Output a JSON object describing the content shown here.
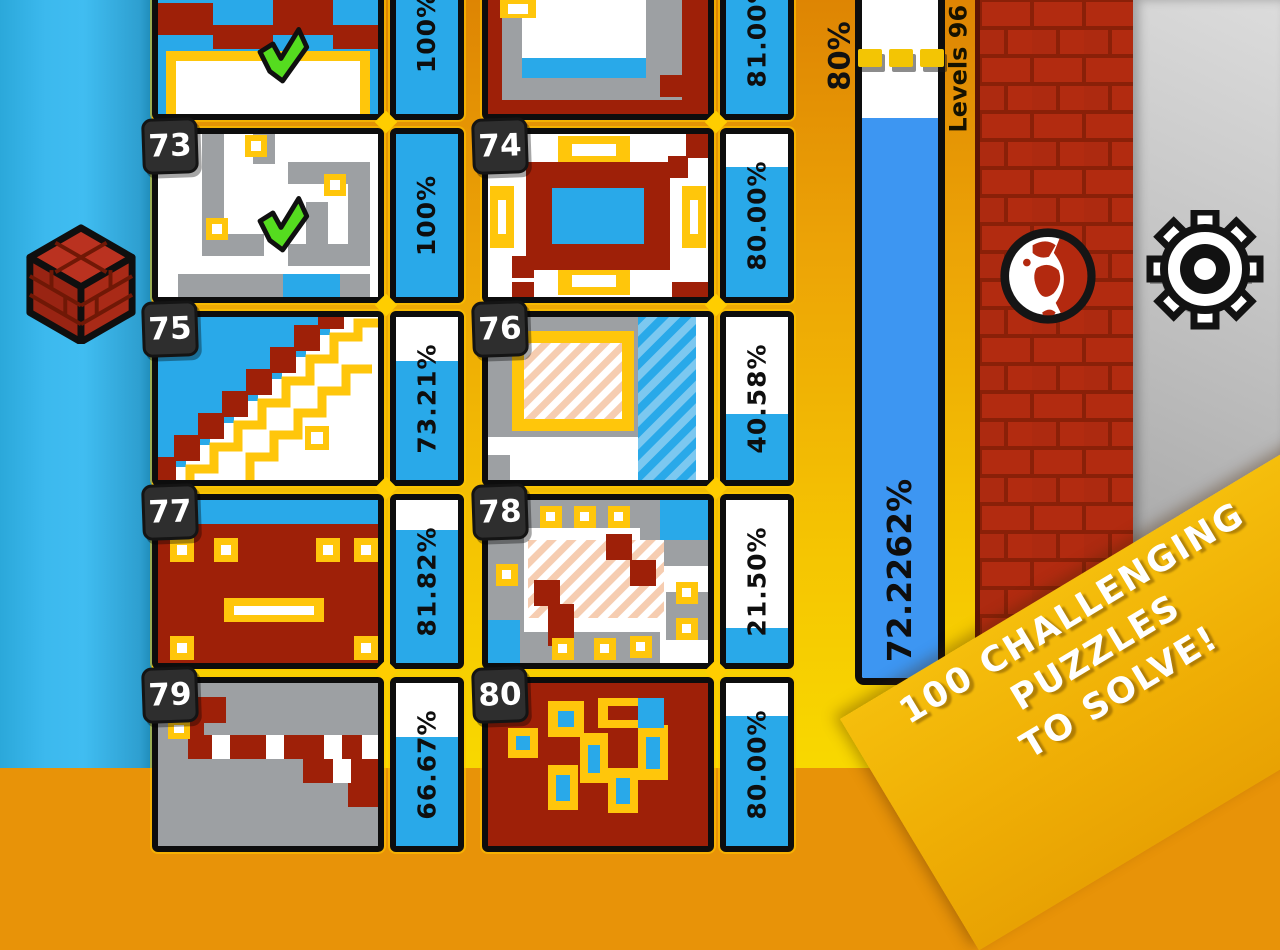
{
  "screen": {
    "width": 1280,
    "height": 768
  },
  "levels": [
    {
      "number": "",
      "percent": "100%",
      "fill": 1.0,
      "completed": true
    },
    {
      "number": "",
      "percent": "81.00%",
      "fill": 0.81,
      "completed": false
    },
    {
      "number": "73",
      "percent": "100%",
      "fill": 1.0,
      "completed": true
    },
    {
      "number": "74",
      "percent": "80.00%",
      "fill": 0.8,
      "completed": false
    },
    {
      "number": "75",
      "percent": "73.21%",
      "fill": 0.7321,
      "completed": false
    },
    {
      "number": "76",
      "percent": "40.58%",
      "fill": 0.4058,
      "completed": false
    },
    {
      "number": "77",
      "percent": "81.82%",
      "fill": 0.8182,
      "completed": false
    },
    {
      "number": "78",
      "percent": "21.50%",
      "fill": 0.215,
      "completed": false
    },
    {
      "number": "79",
      "percent": "66.67%",
      "fill": 0.6667,
      "completed": false
    },
    {
      "number": "80",
      "percent": "80.00%",
      "fill": 0.8,
      "completed": false
    }
  ],
  "progress": {
    "value_label": "72.2262%",
    "fill": 0.722262,
    "threshold_label": "80%",
    "threshold": 0.8,
    "levels_range_label": "Levels 96 - 9"
  },
  "banner": {
    "line1": "100 CHALLENGING",
    "line2": "PUZZLES",
    "line3": "TO SOLVE!"
  },
  "colors": {
    "tile_bar_fill": "#29A9E9",
    "progress_fill": "#3D96F2",
    "banner_gold": "#F0B307",
    "brick_red": "#B22B10",
    "grid_gold_top": "#ECA306",
    "grid_gold_bottom": "#F8D800",
    "left_bg_blue": "#3CB9EE",
    "thumb_red": "#9E2008",
    "thumb_gray": "#9DA0A3",
    "thumb_yellow": "#FFC60B",
    "check_green": "#55DC1F"
  }
}
